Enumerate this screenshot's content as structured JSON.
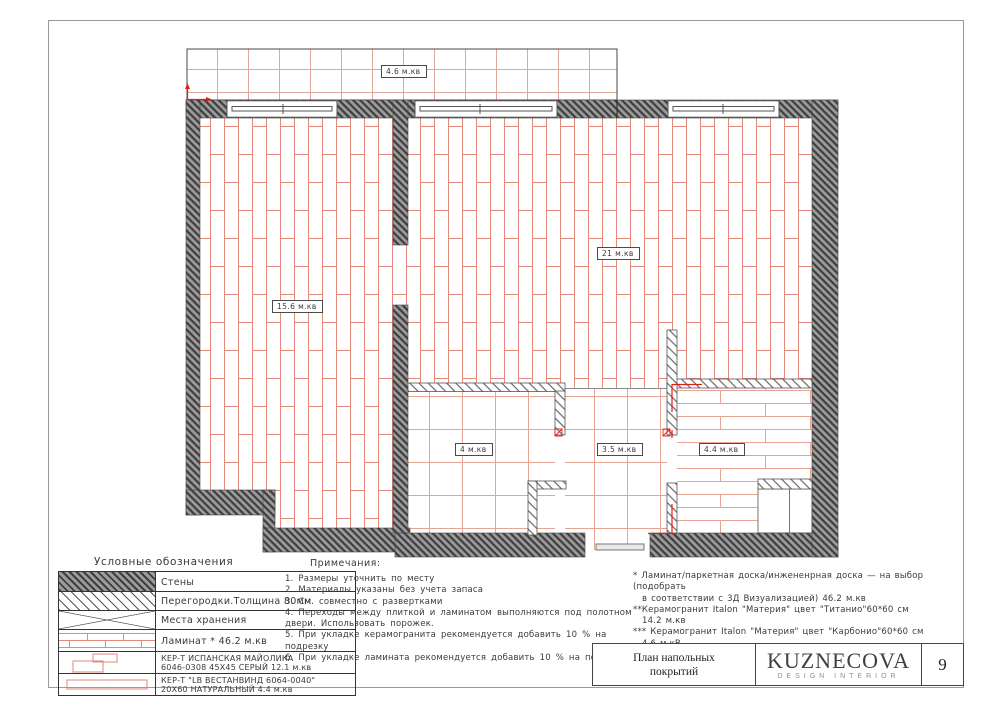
{
  "plan": {
    "room_labels": [
      {
        "name": "balcony",
        "text": "4.6 м.кв"
      },
      {
        "name": "living",
        "text": "15.6 м.кв"
      },
      {
        "name": "kitchen",
        "text": "21 м.кв"
      },
      {
        "name": "bathroom",
        "text": "4 м.кв"
      },
      {
        "name": "wc",
        "text": "3.5 м.кв"
      },
      {
        "name": "hallway",
        "text": "4.4 м.кв"
      }
    ]
  },
  "legend": {
    "title": "Условные обозначения",
    "rows": [
      {
        "label": "Стены"
      },
      {
        "label": "Перегородки.Толщина 80мм"
      },
      {
        "label": "Места хранения"
      },
      {
        "label": "Ламинат *  46.2  м.кв"
      },
      {
        "label": "КЕР-Т ИСПАНСКАЯ МАЙОЛИКА",
        "label2": "6046-0308 45X45 СЕРЫЙ 12.1 м.кв"
      },
      {
        "label": "КЕР-Т \"LB ВЕСТАНВИНД 6064-0040\"",
        "label2": "20X60 НАТУРАЛЬНЫЙ 4.4 м.кв"
      }
    ]
  },
  "notes": {
    "title": "Примечания:",
    "items": [
      "1.  Размеры уточнить по месту",
      "2.  Материалы указаны без учета запаса",
      "3.  См. совместно с развертками",
      "4.  Переходы между плиткой и ламинатом выполняются под полотном двери. Использовать порожек.",
      "5.  При укладке керамогранита рекомендуется добавить 10 % на подрезку",
      "6.  При укладке ламината рекомендуется добавить 10 % на подрезку."
    ]
  },
  "footnotes": {
    "lines": [
      "*  Ламинат/паркетная доска/инжененрная доска —  на выбор (подобрать",
      "в соответствии с 3Д Визуализацией)  46.2  м.кв",
      "**Керамогранит Italon \"Материя\"  цвет \"Титанио\"60*60  см",
      "14.2  м.кв",
      "***  Керамогранит Italon \"Материя\"  цвет \"Карбонио\"60*60  см",
      "4.6  м.кВ"
    ]
  },
  "title_block": {
    "title_line1": "План напольных",
    "title_line2": "покрытий",
    "brand": "KUZNECOVA",
    "brand_sub": "DESIGN INTERIOR",
    "page_number": "9"
  },
  "colors": {
    "laminate_line": "#e2897b",
    "tile_line": "#e7a493",
    "wall_fill": "#9b9b9b",
    "wall_hatch_line": "#3e3e3e",
    "red_mark": "#e01f1a"
  }
}
